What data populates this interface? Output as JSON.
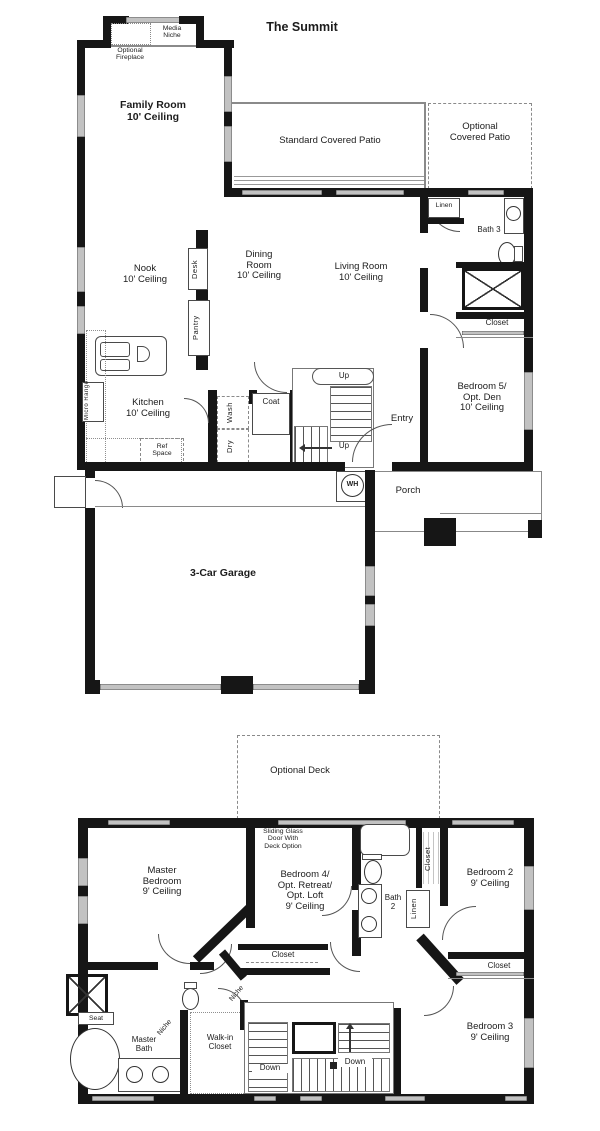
{
  "title": "The Summit",
  "floor1": {
    "media_niche": "Media\nNiche",
    "optional_fireplace": "Optional\nFireplace",
    "family_room": "Family Room\n10' Ceiling",
    "standard_patio": "Standard Covered Patio",
    "optional_patio": "Optional\nCovered Patio",
    "linen": "Linen",
    "bath3": "Bath 3",
    "closet": "Closet",
    "bedroom5": "Bedroom 5/\nOpt. Den\n10' Ceiling",
    "nook": "Nook\n10' Ceiling",
    "desk": "Desk",
    "pantry": "Pantry",
    "dining_room": "Dining\nRoom\n10' Ceiling",
    "living_room": "Living Room\n10' Ceiling",
    "kitchen": "Kitchen\n10' Ceiling",
    "micro_range": "Micro Range",
    "ref_space": "Ref\nSpace",
    "wash": "Wash",
    "dry": "Dry",
    "coat": "Coat",
    "up_upper": "Up",
    "up_lower": "Up",
    "entry": "Entry",
    "water_heater": "WH",
    "porch": "Porch",
    "garage": "3-Car Garage"
  },
  "floor2": {
    "optional_deck": "Optional Deck",
    "sliding_glass_note": "Sliding Glass\nDoor With\nDeck Option",
    "master_bedroom": "Master\nBedroom\n9' Ceiling",
    "bedroom4": "Bedroom 4/\nOpt. Retreat/\nOpt. Loft\n9' Ceiling",
    "bath2": "Bath\n2",
    "linen": "Linen",
    "closet_bath_hall": "Closet",
    "bedroom2": "Bedroom 2\n9' Ceiling",
    "closet_bedroom4": "Closet",
    "closet_bedroom2": "Closet",
    "niche_upper": "Niche",
    "niche_lower": "Niche",
    "seat": "Seat",
    "master_bath": "Master\nBath",
    "walkin_closet": "Walk-in\nCloset",
    "down_1": "Down",
    "down_2": "Down",
    "down_3": "Down",
    "bedroom3": "Bedroom 3\n9' Ceiling"
  },
  "colors": {
    "wall": "#161616",
    "window_glass": "#c2c2c2",
    "text": "#1c1c1c",
    "background": "#ffffff"
  }
}
